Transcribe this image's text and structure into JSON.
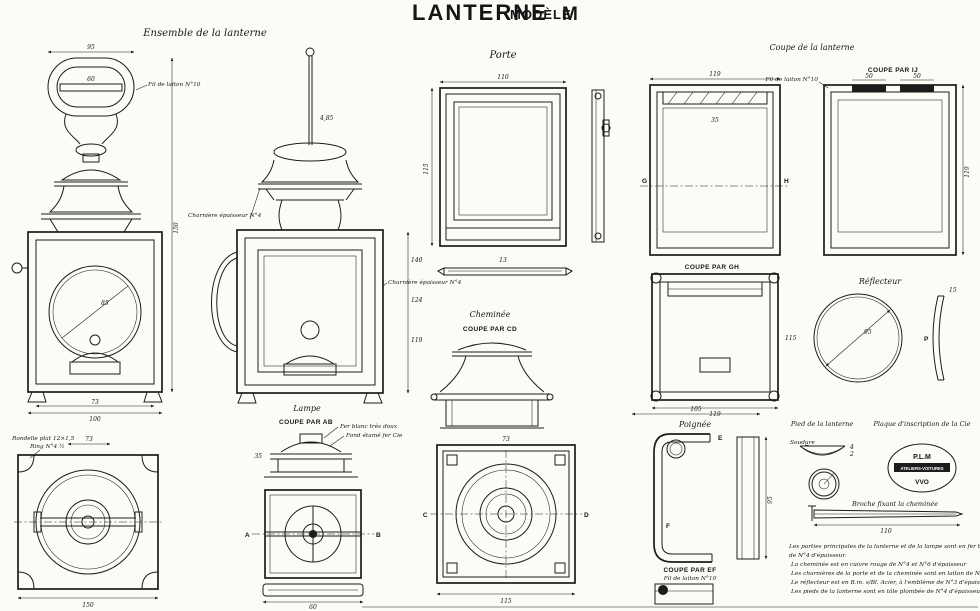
{
  "title": {
    "word1": "LANTERNE",
    "word2": "MODÈLE",
    "word3": "M"
  },
  "views": {
    "ensemble": {
      "label": "Ensemble de la lanterne",
      "fil": "Fil de laiton N°10",
      "dims": [
        "95",
        "60",
        "150",
        "85",
        "73",
        "100"
      ]
    },
    "profil": {
      "charniere1": "Charnière épaisseur N°4",
      "charniere2": "Charnière épaisseur N°4",
      "dims": [
        "4,85",
        "140",
        "124",
        "119"
      ]
    },
    "porte": {
      "label": "Porte",
      "dims": [
        "110",
        "115",
        "13"
      ]
    },
    "coupe_lanterne": {
      "label": "Coupe de la lanterne",
      "letters": [
        "G",
        "H"
      ],
      "dims": [
        "119",
        "35"
      ]
    },
    "coupe_ij": {
      "label": "COUPE PAR IJ",
      "annotation": "Fil de laiton N°10",
      "dims": [
        "50",
        "50",
        "119"
      ]
    },
    "coupe_gh": {
      "label": "COUPE PAR GH",
      "dims": [
        "119",
        "115"
      ]
    },
    "reflecteur": {
      "label": "Réflecteur",
      "letter": "P",
      "dims": [
        "95",
        "15"
      ]
    },
    "cheminee": {
      "label": "Cheminée",
      "coupe_label": "COUPE PAR CD",
      "letters": [
        "C",
        "D"
      ],
      "dims": [
        "73",
        "115"
      ]
    },
    "lampe": {
      "label": "Lampe",
      "coupe_label": "COUPE PAR AB",
      "annotations": [
        "Fer blanc très doux",
        "Fond étamé fer Cie"
      ],
      "letters": [
        "A",
        "B"
      ],
      "dims": [
        "35",
        "60"
      ]
    },
    "base": {
      "annotations": [
        "Rondelle plat 12×1,5",
        "Ring N°4 ½"
      ],
      "dims": [
        "73",
        "150"
      ]
    },
    "poignee": {
      "label": "Poignée",
      "coupe_label": "COUPE PAR EF",
      "annotation": "Fil de laiton N°10",
      "letters": [
        "E",
        "F"
      ],
      "dims": [
        "105",
        "95"
      ]
    },
    "pied": {
      "label": "Pied de la lanterne",
      "annotation": "Soudure",
      "dims": [
        "4",
        "2"
      ]
    },
    "plaque": {
      "label": "Plaque d'inscription de la Cie",
      "stamp_line1": "P.L.M",
      "stamp_line2": "ATELIERS-VOITURES",
      "stamp_line3": "VVO"
    },
    "broche": {
      "label": "Broche fixant la cheminée",
      "dims": [
        "110"
      ]
    }
  },
  "notes": {
    "lines": [
      "Les parties principales de la lanterne et de la lampe sont en fer blanc",
      "de N°4 d'épaisseur.",
      "La cheminée est en cuivre rouge de N°4 et N°6 d'épaisseur",
      "Les charnières de la porte et de la cheminée sont en laiton de N°4 d'épaisseur",
      "Le réflecteur est en B.m. s/Bl. Acier, à l'emblème de N°3 d'épaisseur",
      "Les pieds de la lanterne sont en tôle plombée de N°4 d'épaisseur"
    ]
  },
  "colors": {
    "ink": "#1c1c1c",
    "paper": "#fcfbf6"
  }
}
